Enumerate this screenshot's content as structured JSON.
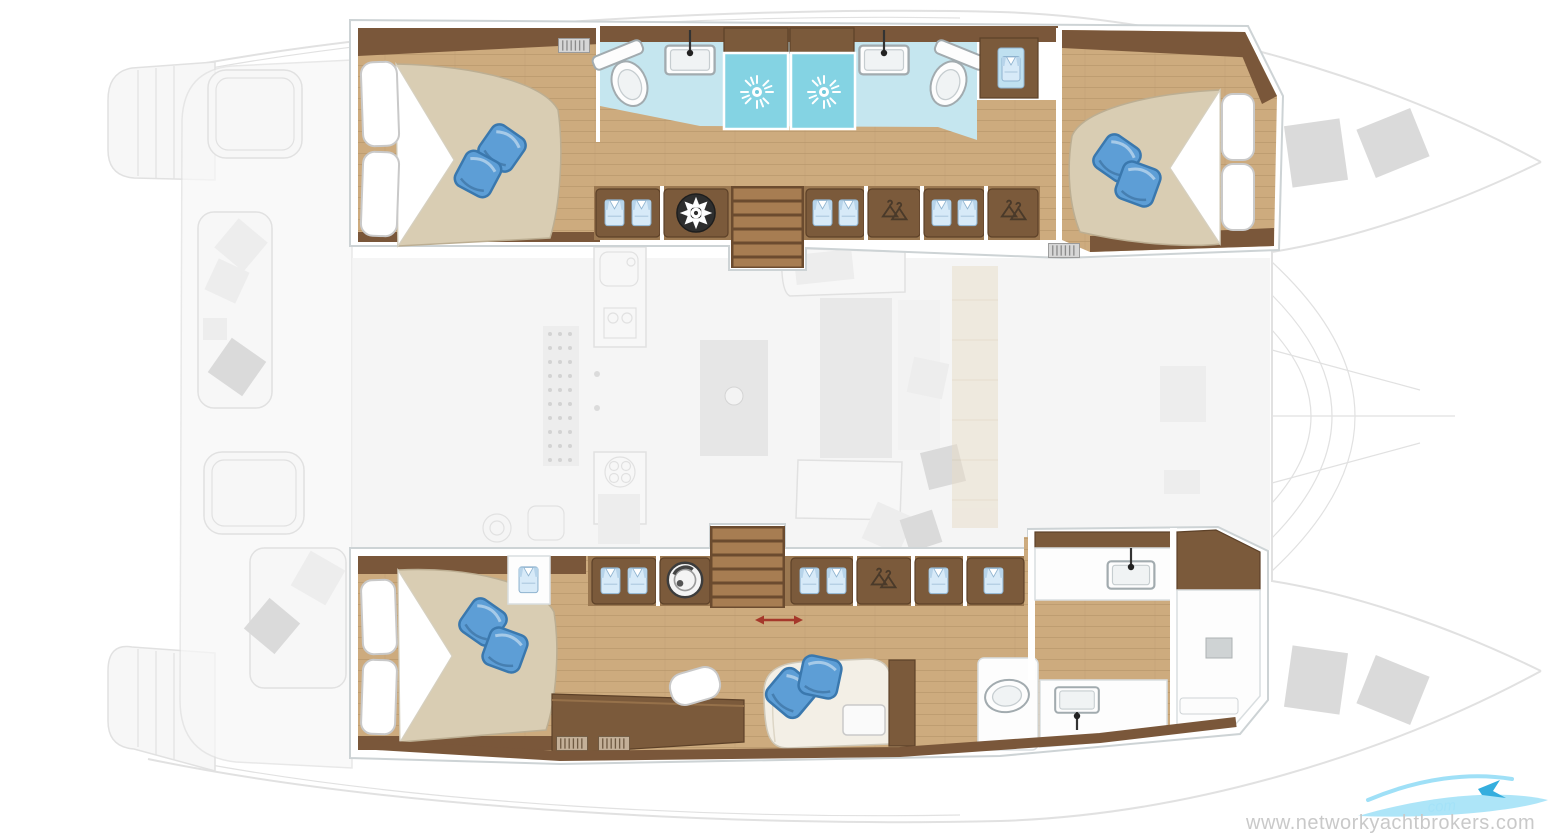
{
  "watermark": {
    "text": "www.networkyachtbrokers.com"
  },
  "colors": {
    "woodLight": "#cdab7e",
    "woodMid": "#9b7851",
    "woodDark": "#7a573a",
    "cabinet": "#7b5a3b",
    "cabinetEdge": "#5d4128",
    "bedBeige": "#d9cdb3",
    "bathFloor": "#c5e6ef",
    "showerTeal": "#84d3e3",
    "pillowBlue": "#5d9ed6",
    "pillowBlueDark": "#3a78ae",
    "fadedLine": "#dedede",
    "fadedFill": "#f7f7f7",
    "fadedFill2": "#ececec",
    "fadedDark": "#d7d7d7",
    "frameStroke": "#cdd3d5",
    "fixtureStroke": "#a2abaf",
    "accentRed": "#a5382b",
    "watermarkGray": "#c9c9c9",
    "logoBlue": "#9fe0f7",
    "logoBlueDark": "#35aede"
  },
  "diagram": {
    "type": "yacht-floor-plan",
    "vessel": "sailing-catamaran",
    "view": "interior-deck-top-view",
    "hulls": [
      {
        "id": "port-hull",
        "position": "top",
        "rooms": [
          {
            "name": "aft-cabin",
            "furniture": [
              "double-bed",
              "white-pillows-2",
              "blue-accent-pillows-2",
              "air-vent-grille"
            ]
          },
          {
            "name": "central-bathroom",
            "fixtures": [
              "sink-with-faucet",
              "sink-with-faucet",
              "toilet",
              "toilet",
              "shower-with-drain",
              "shower-with-drain",
              "wardrobe-locker-with-shirt"
            ]
          },
          {
            "name": "companionway",
            "features": [
              "staircase-to-saloon",
              "storage-cabinet-folded-clothes-2",
              "fan-vent",
              "storage-cabinet-folded-clothes-2",
              "hanging-locker",
              "storage-cabinet-folded-clothes-2",
              "hanging-locker"
            ]
          },
          {
            "name": "forward-cabin",
            "furniture": [
              "double-bed",
              "white-pillows-2",
              "blue-accent-pillows-2",
              "air-vent-grille"
            ]
          }
        ]
      },
      {
        "id": "starboard-hull",
        "position": "bottom",
        "rooms": [
          {
            "name": "aft-cabin",
            "furniture": [
              "double-bed",
              "white-pillows-2",
              "blue-accent-pillows-2",
              "shirt-locker"
            ]
          },
          {
            "name": "companionway",
            "features": [
              "washing-machine",
              "staircase-to-saloon",
              "sliding-door-red-arrow",
              "storage-cabinet-folded-clothes-2",
              "hanging-locker",
              "shirt-locker",
              "shirt-locker"
            ]
          },
          {
            "name": "lounge-vanity",
            "furniture": [
              "desk-vanity",
              "chair",
              "sofa",
              "blue-accent-pillows-2",
              "side-table",
              "air-vent-grilles-2"
            ]
          },
          {
            "name": "bathroom",
            "fixtures": [
              "toilet-compartment",
              "toilet",
              "sink-with-faucet"
            ]
          },
          {
            "name": "forward-head",
            "fixtures": [
              "sink-with-faucet",
              "wardrobe",
              "mirror",
              "vanity-shelf"
            ]
          }
        ]
      }
    ],
    "exterior_faded": {
      "aft": [
        "transom-steps-port",
        "transom-steps-starboard",
        "cockpit-bench-with-cushions",
        "cockpit-tables-2",
        "aft-sofa-with-cushions"
      ],
      "saloon": [
        "galley-counters",
        "stove-grid",
        "sink-unit",
        "island-unit",
        "dinette-table",
        "dinette-sofa",
        "scatter-cushions",
        "side-walkway"
      ],
      "foredeck": [
        "trampoline-net",
        "deck-hatches-4",
        "bow-port",
        "bow-starboard"
      ]
    }
  }
}
